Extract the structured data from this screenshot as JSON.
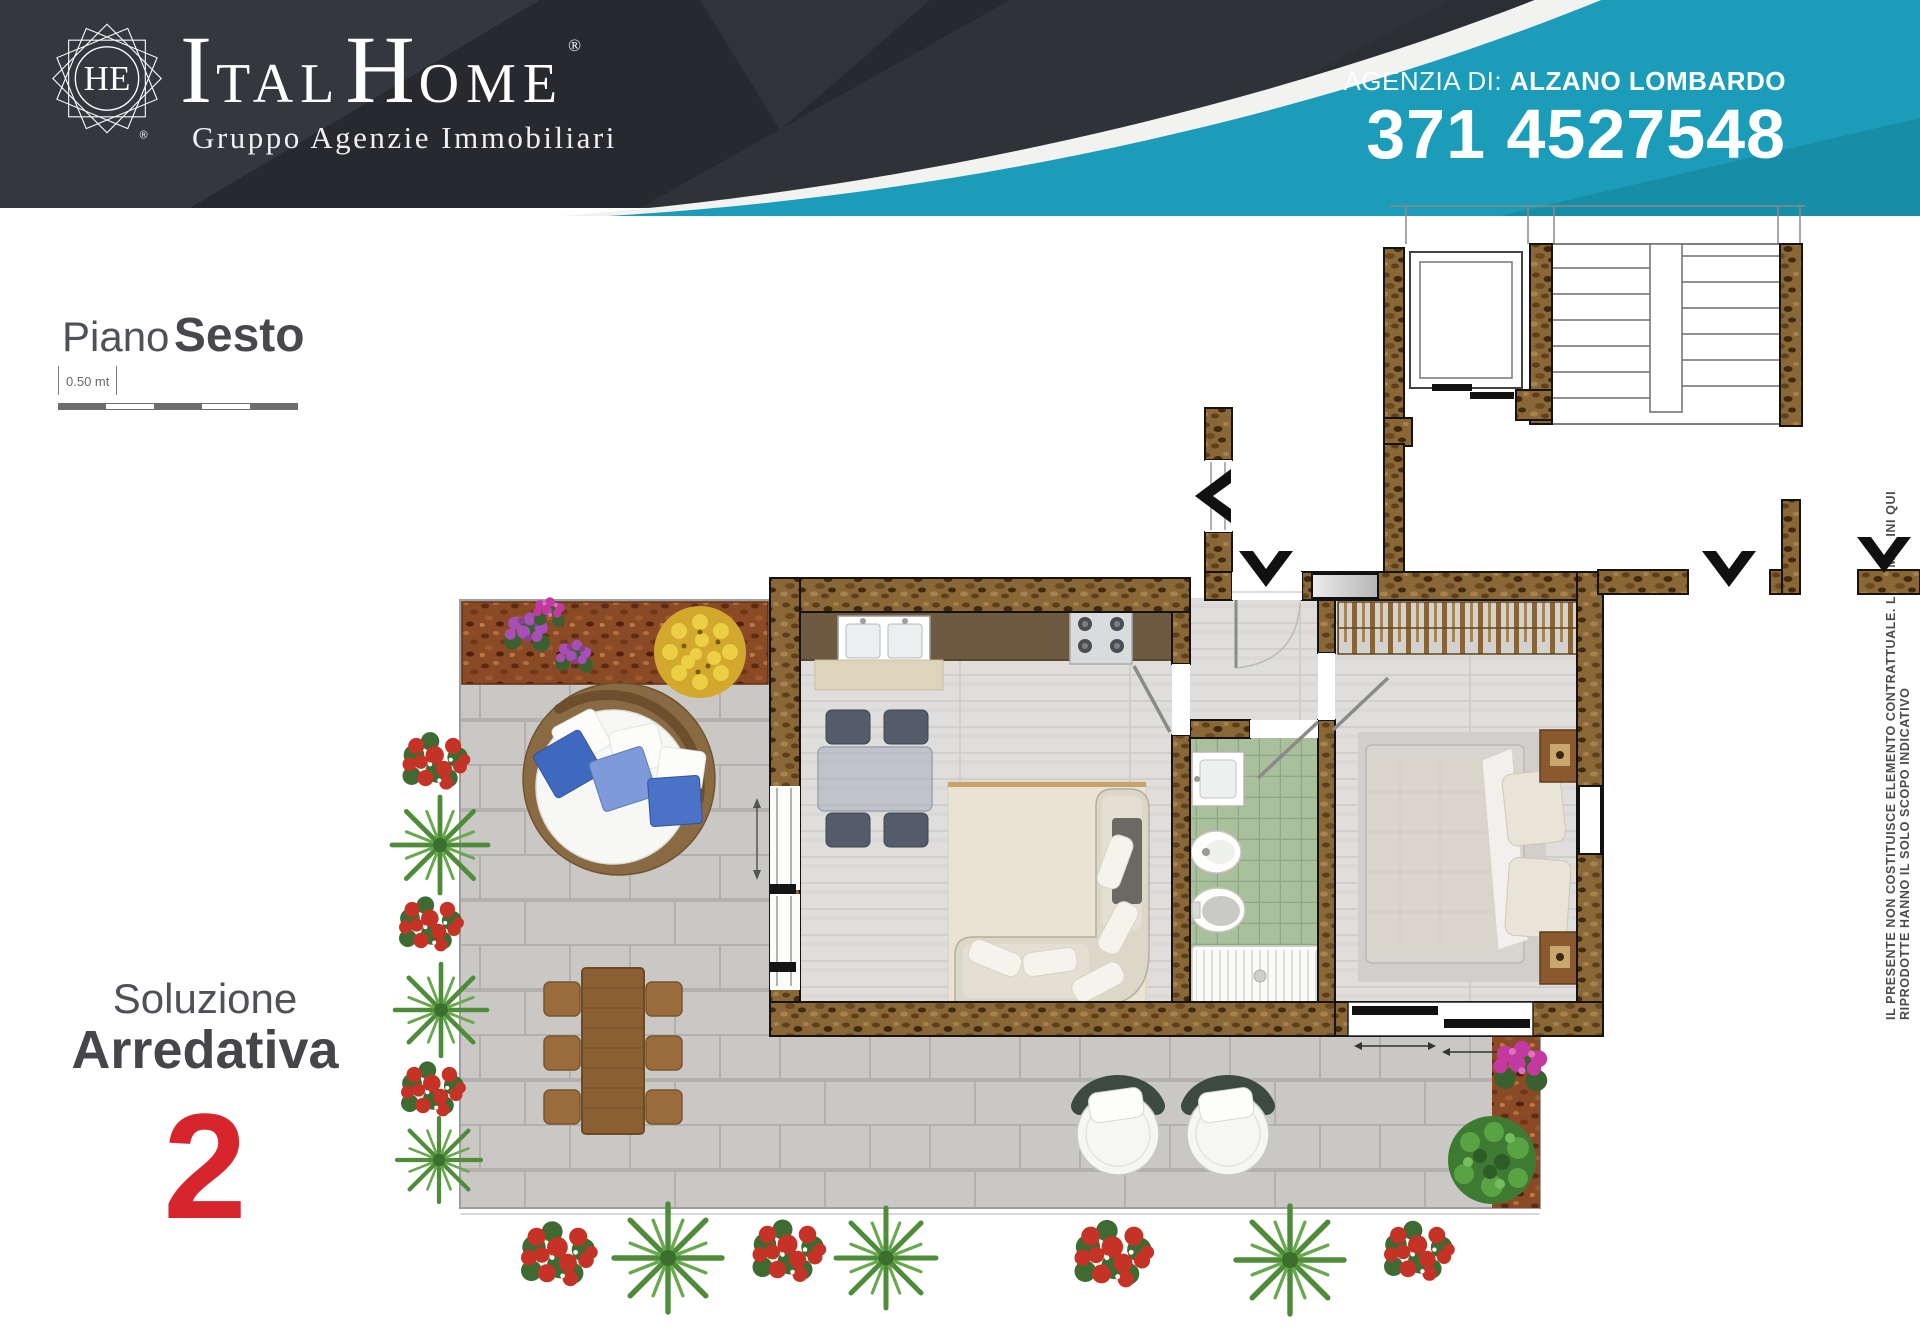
{
  "header": {
    "logo": {
      "monogram": "HE",
      "registered": "®"
    },
    "brand": {
      "l1": "I",
      "l2": "TAL",
      "l3": "H",
      "l4": "OME",
      "registered": "®",
      "tagline": "Gruppo Agenzie Immobiliari"
    },
    "agency": {
      "label": "AGENZIA DI:",
      "name": "ALZANO LOMBARDO",
      "phone": "371 4527548"
    },
    "colors": {
      "dark": "#2b2e33",
      "cyan": "#1b9cb9",
      "stripe": "#f2f2f0"
    }
  },
  "floor": {
    "label": "Piano",
    "value": "Sesto"
  },
  "scale_bar": {
    "label": "0.50 mt",
    "segments": 5
  },
  "solution": {
    "line1": "Soluzione",
    "line2": "Arredativa",
    "number": "2",
    "number_color": "#d6252d"
  },
  "disclaimer": "IL PRESENTE NON COSTITUISCE ELEMENTO CONTRATTUALE. LE IMMAGINI QUI RIPRODOTTE HANNO IL SOLO SCOPO INDICATIVO",
  "floor_plan": {
    "elements": [
      "staircase",
      "elevator",
      "entry-arrows",
      "kitchen",
      "living-room",
      "bathroom",
      "bedroom",
      "wardrobe",
      "terrace",
      "round-daybed",
      "outdoor-dining-table",
      "lounge-chairs",
      "planters"
    ],
    "colors": {
      "wall": "#8a6737",
      "paving": "#cbc9c5",
      "wood_floor": "#dfdedc",
      "bath_tiles": "#aabf9c",
      "mulch": "#8a4a26"
    }
  }
}
